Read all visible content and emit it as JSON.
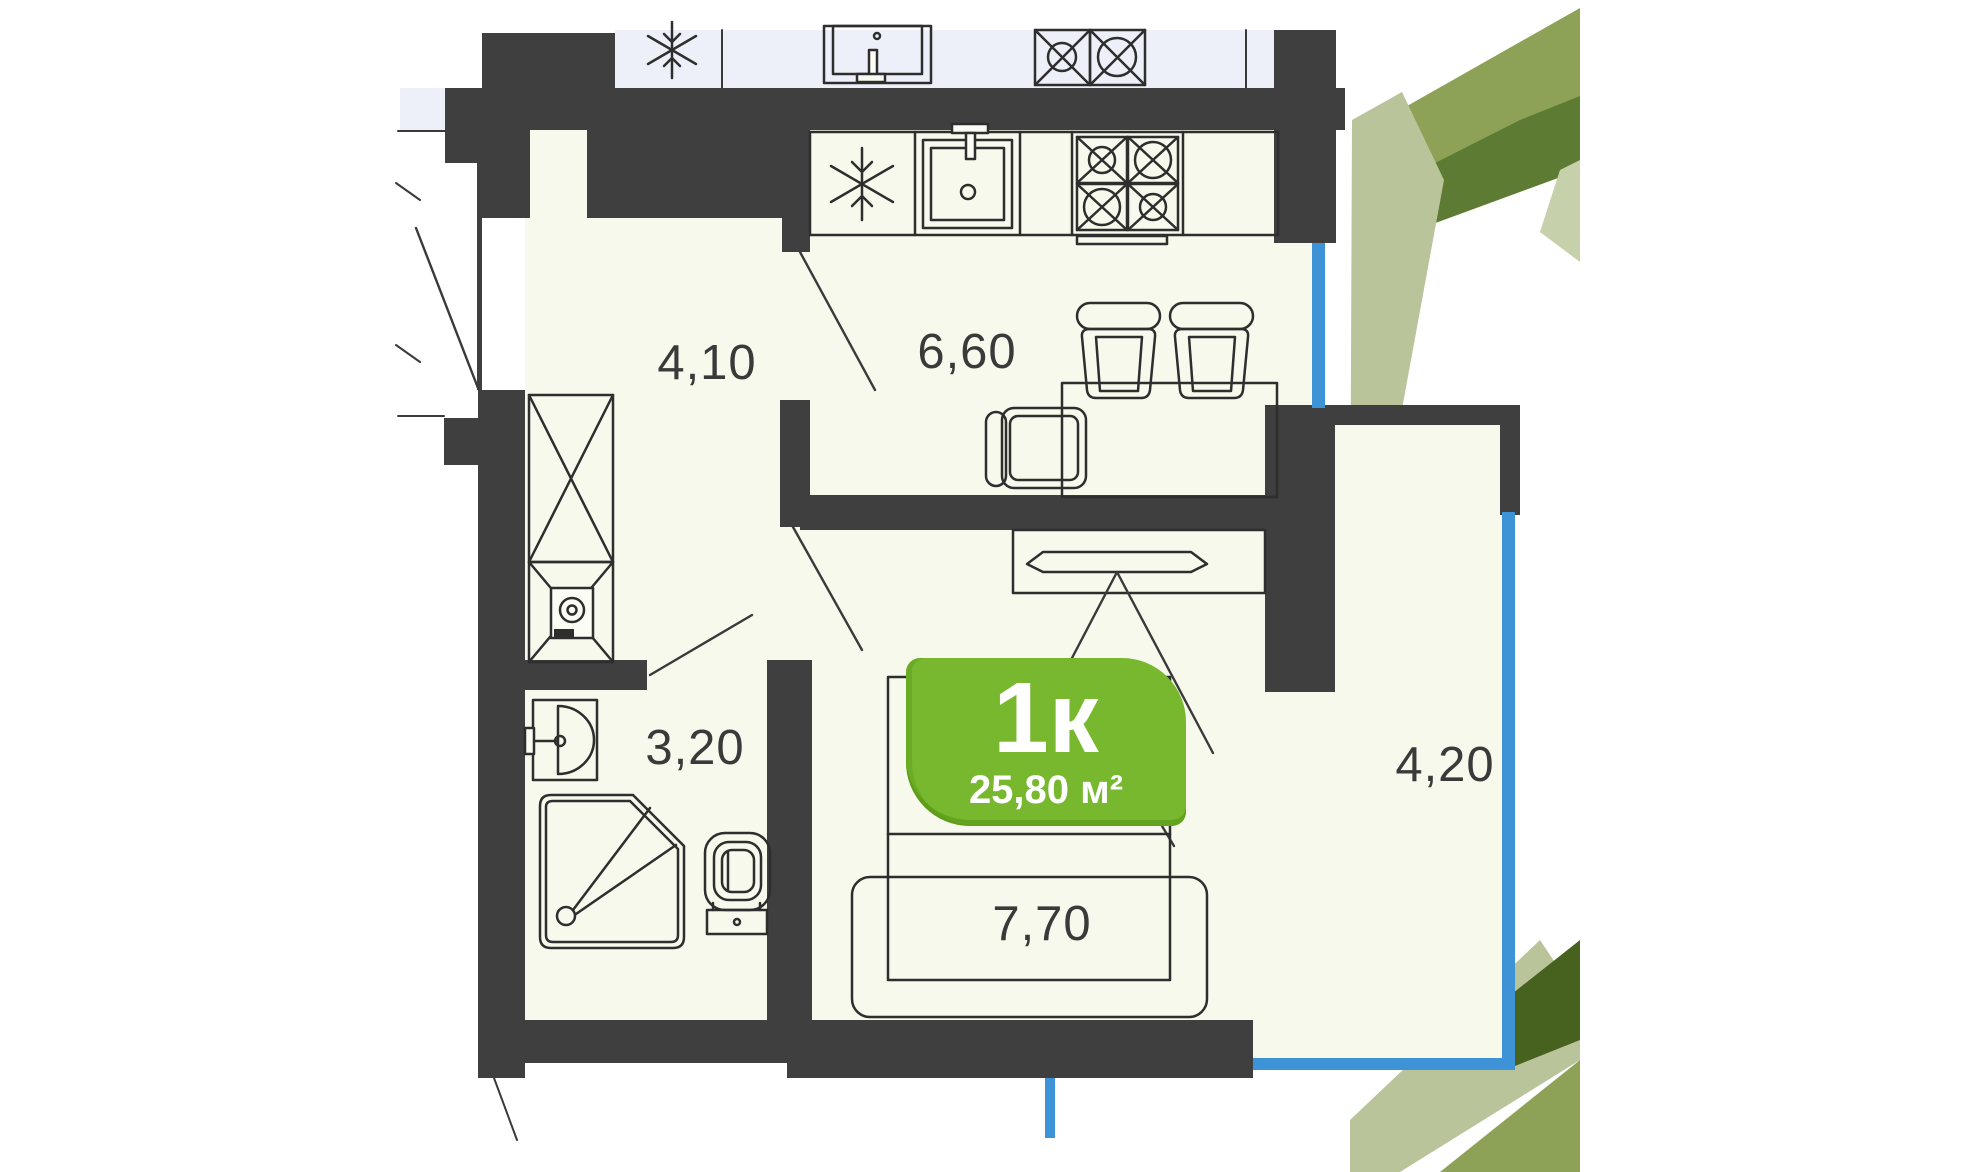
{
  "badge": {
    "type": "1к",
    "area": "25,80 м²"
  },
  "rooms": {
    "hallway": {
      "label": "4,10"
    },
    "kitchen": {
      "label": "6,60"
    },
    "bathroom": {
      "label": "3,20"
    },
    "living": {
      "label": "7,70"
    },
    "balcony": {
      "label": "4,20"
    }
  },
  "colors": {
    "wall": "#3f3f3f",
    "floor": "#f7f9ec",
    "upper_floor": "#edf0f8",
    "glazing": "#3e93d6",
    "badge_green": "#77b82f",
    "badge_green_dark": "#539212",
    "outline": "#2e2e2e",
    "label_text": "#3a3a3a",
    "leaf_medium": "#8da257",
    "leaf_dark": "#5e7b33",
    "leaf_darkest": "#47621f",
    "leaf_light": "#b9c49b",
    "leaf_pale": "#c6d0ab"
  },
  "icons": [
    "fridge-snowflake-icon",
    "sink-icon",
    "stove-icon",
    "wardrobe-icon",
    "washing-machine-icon",
    "washbasin-icon",
    "shower-icon",
    "toilet-icon",
    "bar-stool-icon",
    "chair-icon",
    "dining-table-icon",
    "tv-icon",
    "bed-icon",
    "window-glazing",
    "door-swing"
  ]
}
